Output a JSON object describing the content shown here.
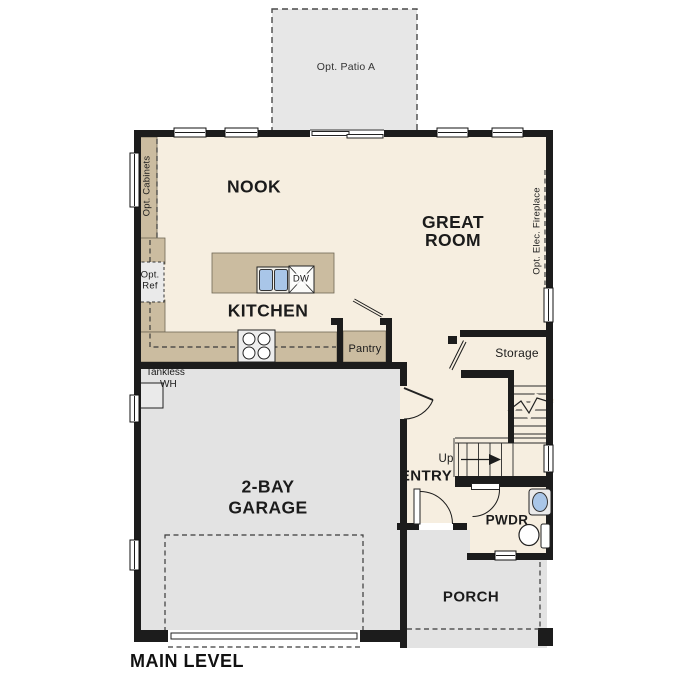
{
  "plan_title": "MAIN LEVEL",
  "rooms": {
    "nook": {
      "label": "NOOK"
    },
    "great_room": {
      "line1": "GREAT",
      "line2": "ROOM"
    },
    "kitchen": {
      "label": "KITCHEN"
    },
    "garage": {
      "line1": "2-BAY",
      "line2": "GARAGE"
    },
    "entry": {
      "label": "ENTRY"
    },
    "powder": {
      "label": "PWDR"
    },
    "porch": {
      "label": "PORCH"
    },
    "storage": {
      "label": "Storage"
    },
    "pantry": {
      "label": "Pantry"
    }
  },
  "annotations": {
    "patio": "Opt. Patio A",
    "cabinets": "Opt. Cabinets",
    "fireplace": "Opt. Elec. Fireplace",
    "ref_line1": "Opt.",
    "ref_line2": "Ref",
    "tankless_line1": "Tankless",
    "tankless_line2": "WH",
    "stairs_up": "Up",
    "dishwasher": "DW"
  },
  "colors": {
    "wall": "#1c1c1c",
    "floor": "#f6eee0",
    "cabinet": "#cbbca0",
    "garage_floor": "#e3e3e3",
    "patio_floor": "#e7e7e7",
    "fixture_blue": "#a9c6e8"
  }
}
